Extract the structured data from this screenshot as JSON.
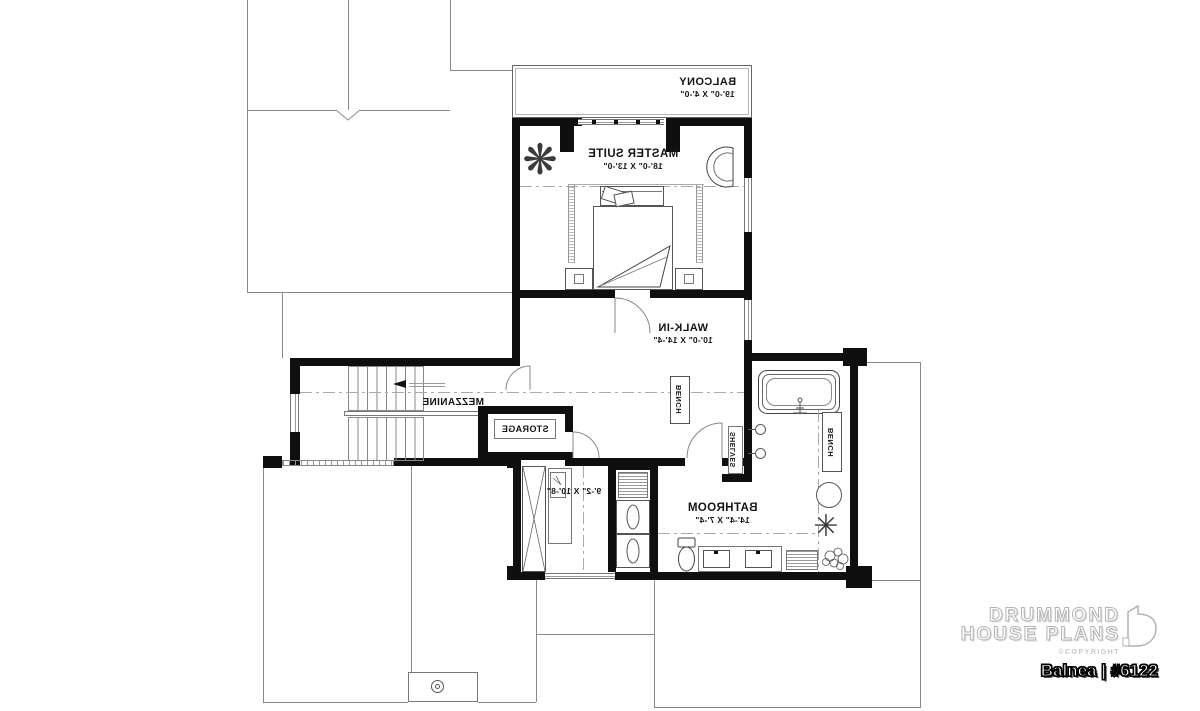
{
  "plan": {
    "balcony": {
      "name": "BALCONY",
      "dims": "19'-0\" X 4'-0\""
    },
    "master": {
      "name": "MASTER SUITE",
      "dims": "18'-0\" X 13'-0\""
    },
    "walkin": {
      "name": "WALK-IN",
      "dims": "10'-0\" X 14'-4\""
    },
    "mezzanine": {
      "name": "MEZZANINE"
    },
    "storage": {
      "name": "STORAGE"
    },
    "laundry": {
      "dims": "9'-2\" X 10'-8\""
    },
    "bathroom": {
      "name": "BATHROOM",
      "dims": "14'-4\" X 7'-4\""
    },
    "bench_walkin": "BENCH",
    "bench_bath": "BENCH",
    "shelves": "SHELVES",
    "plant_glyph_master": "❋",
    "plant_glyph_bath": "✳"
  },
  "branding": {
    "brand_line1": "DRUMMOND",
    "brand_line2": "HOUSE PLANS",
    "copyright": "©COPYRIGHT",
    "plan_title": "Balnea | #6122"
  },
  "colors": {
    "wall": "#0f0f0f",
    "thin_line": "#8a8a8a",
    "text": "#151515"
  }
}
